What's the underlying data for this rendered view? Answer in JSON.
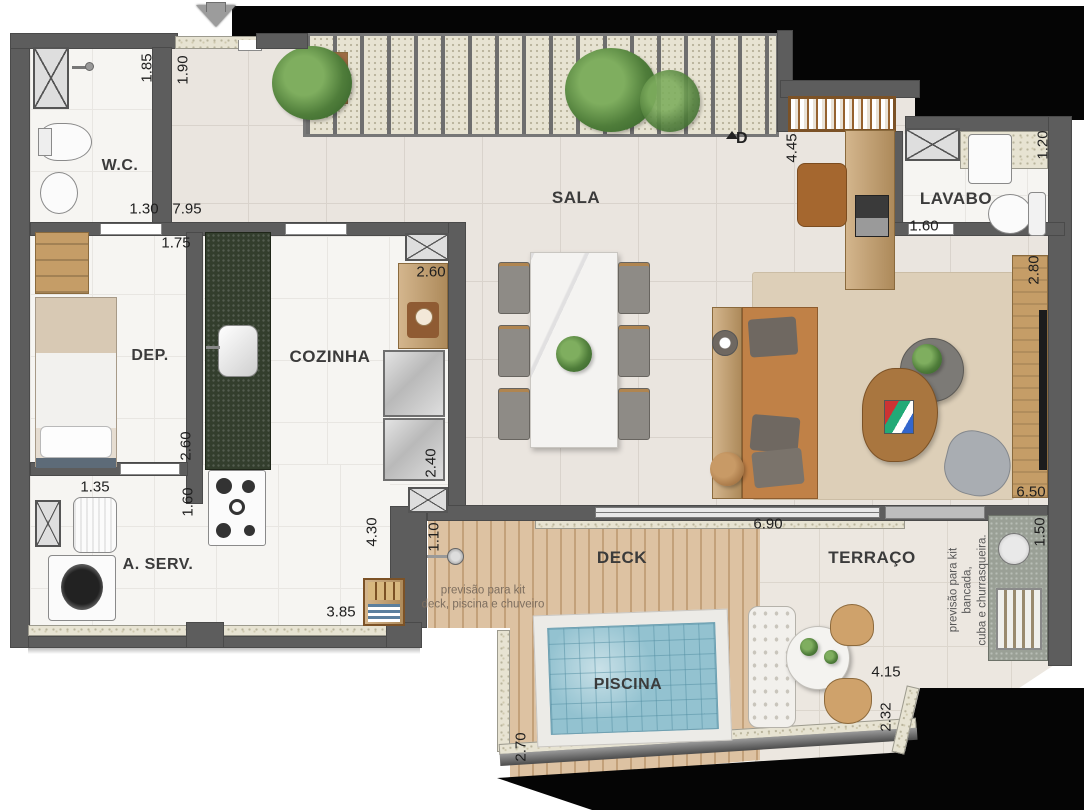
{
  "plan": {
    "type": "residential floor plan",
    "rooms": [
      {
        "id": "wc",
        "label": "W.C.",
        "x": 120,
        "y": 166,
        "size": 16
      },
      {
        "id": "sala",
        "label": "SALA",
        "x": 576,
        "y": 198,
        "size": 17
      },
      {
        "id": "lavabo",
        "label": "LAVABO",
        "x": 956,
        "y": 199,
        "size": 17
      },
      {
        "id": "dep",
        "label": "DEP.",
        "x": 150,
        "y": 356,
        "size": 16
      },
      {
        "id": "cozinha",
        "label": "COZINHA",
        "x": 330,
        "y": 357,
        "size": 17
      },
      {
        "id": "aserv",
        "label": "A. SERV.",
        "x": 158,
        "y": 565,
        "size": 16
      },
      {
        "id": "deck",
        "label": "DECK",
        "x": 622,
        "y": 558,
        "size": 17
      },
      {
        "id": "terraco",
        "label": "TERRAÇO",
        "x": 872,
        "y": 558,
        "size": 17
      },
      {
        "id": "piscina",
        "label": "PISCINA",
        "x": 628,
        "y": 685,
        "size": 16
      }
    ],
    "dimensions": [
      {
        "value": "1.85",
        "x": 147,
        "y": 68,
        "vertical": true
      },
      {
        "value": "1.90",
        "x": 183,
        "y": 70,
        "vertical": true
      },
      {
        "value": "1.30",
        "x": 144,
        "y": 209,
        "vertical": false
      },
      {
        "value": "7.95",
        "x": 187,
        "y": 209,
        "vertical": false
      },
      {
        "value": "1.75",
        "x": 176,
        "y": 243,
        "vertical": false
      },
      {
        "value": "2.60",
        "x": 186,
        "y": 446,
        "vertical": true
      },
      {
        "value": "1.60",
        "x": 188,
        "y": 502,
        "vertical": true
      },
      {
        "value": "1.35",
        "x": 95,
        "y": 487,
        "vertical": false
      },
      {
        "value": "2.60",
        "x": 431,
        "y": 272,
        "vertical": false
      },
      {
        "value": "2.40",
        "x": 431,
        "y": 463,
        "vertical": true
      },
      {
        "value": "4.30",
        "x": 372,
        "y": 532,
        "vertical": true
      },
      {
        "value": "1.10",
        "x": 434,
        "y": 537,
        "vertical": true
      },
      {
        "value": "3.85",
        "x": 341,
        "y": 612,
        "vertical": false
      },
      {
        "value": "4.45",
        "x": 792,
        "y": 148,
        "vertical": true
      },
      {
        "value": "1.20",
        "x": 1043,
        "y": 145,
        "vertical": true
      },
      {
        "value": "1.60",
        "x": 924,
        "y": 226,
        "vertical": false
      },
      {
        "value": "2.80",
        "x": 1034,
        "y": 270,
        "vertical": true
      },
      {
        "value": "6.50",
        "x": 1031,
        "y": 492,
        "vertical": false
      },
      {
        "value": "6.90",
        "x": 768,
        "y": 524,
        "vertical": false
      },
      {
        "value": "1.50",
        "x": 1040,
        "y": 532,
        "vertical": true
      },
      {
        "value": "4.15",
        "x": 886,
        "y": 672,
        "vertical": false
      },
      {
        "value": "2.32",
        "x": 886,
        "y": 717,
        "vertical": true
      },
      {
        "value": "2.70",
        "x": 521,
        "y": 747,
        "vertical": true
      }
    ],
    "notes": [
      {
        "text": "previsão para kit\ndeck, piscina e chuveiro",
        "x": 483,
        "y": 598,
        "vertical": false
      },
      {
        "text": "previsão para kit bancada,\ncuba e churrasqueira.",
        "x": 968,
        "y": 590,
        "vertical": true
      }
    ],
    "markers": {
      "d_label": "D"
    },
    "colors": {
      "wall": "#5d5d5d",
      "mask": "#050505",
      "floor_social": "#eae5df",
      "floor_service": "#f6f5f2",
      "deck_wood": "#ddc2a2",
      "pool_water": "#93c2d0",
      "island_granite": "#333e2d",
      "sofa": "#c08147",
      "rug": "#ddcfb8",
      "sill_granite": "#e7e3d2",
      "accent_wood": "#c59d67"
    }
  }
}
